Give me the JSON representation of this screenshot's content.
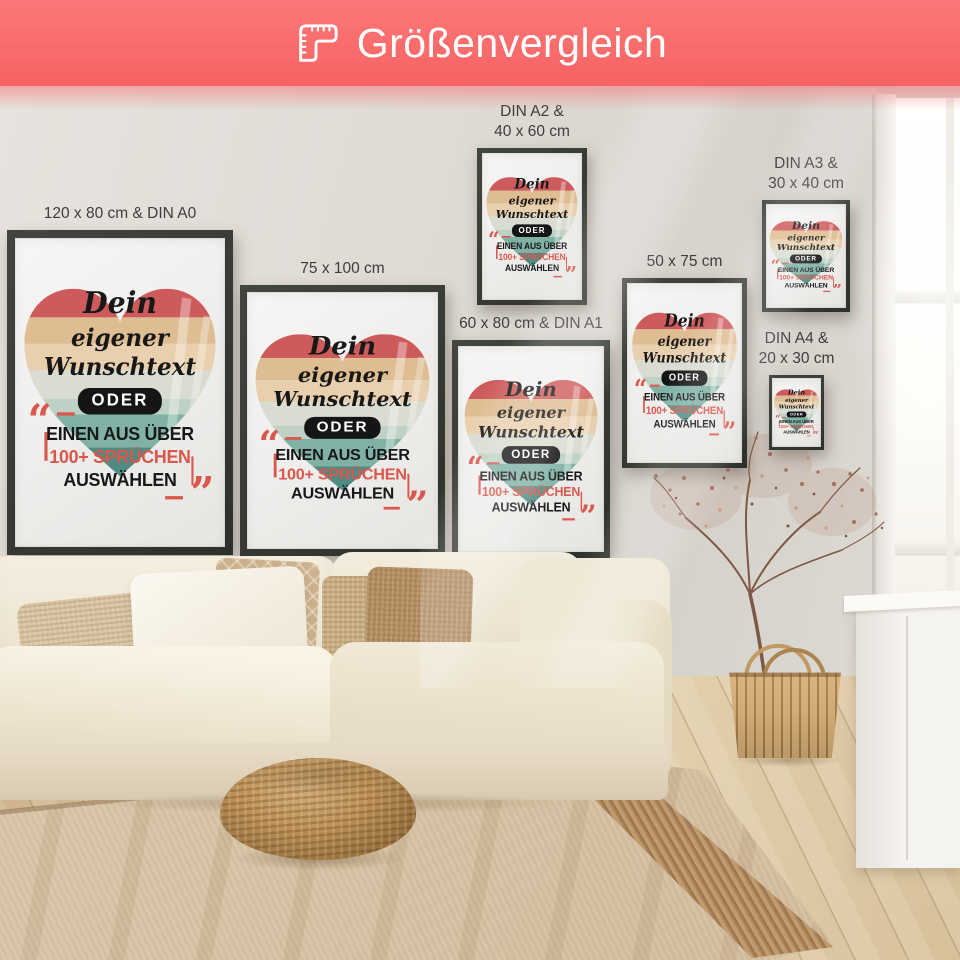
{
  "header": {
    "title": "Größenvergleich"
  },
  "posters": [
    {
      "label": "120 x 80 cm & DIN A0"
    },
    {
      "label": "75 x 100 cm"
    },
    {
      "label": "DIN A2 &\n40 x 60 cm"
    },
    {
      "label": "60 x 80 cm & DIN A1"
    },
    {
      "label": "50 x 75 cm"
    },
    {
      "label": "DIN A3 &\n30 x 40 cm"
    },
    {
      "label": "DIN A4 &\n20 x 30 cm"
    }
  ],
  "artwork": {
    "line1": "Dein",
    "line2": "eigener",
    "line3": "Wunschtext",
    "or_label": "ODER",
    "line4": "EINEN AUS ÜBER",
    "line5": "100+ SPRÜCHEN",
    "line6": "AUSWÄHLEN",
    "quote_open": "“",
    "quote_close": "”"
  },
  "theme": {
    "banner": "#f96a6a",
    "banner-text": "#ffffff",
    "label": "#3e3d3b",
    "accent-red": "#d9574c",
    "text-dark": "#181818",
    "stripe-red": "#ce5b5c",
    "stripe-tan": "#dfbd92",
    "stripe-light-tan": "#e8d0ae",
    "stripe-sage": "#d9dcd0",
    "stripe-pale-teal": "#bdd2c5",
    "stripe-teal": "#7fb2a5",
    "stripe-dark-teal": "#4f8b82"
  }
}
